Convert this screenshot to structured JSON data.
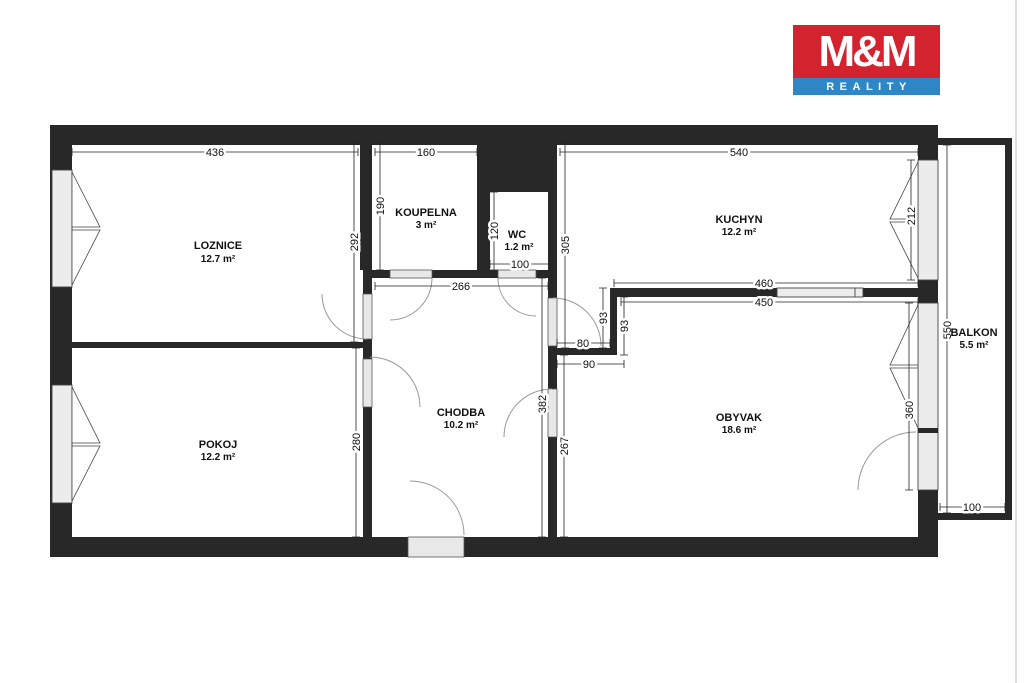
{
  "logo": {
    "line1": "M&M",
    "line2": "REALITY",
    "brand_red": "#d2232e",
    "brand_blue": "#2e86c7"
  },
  "plan": {
    "wall_color": "#282828"
  },
  "rooms": [
    {
      "id": "loznice",
      "name": "LOZNICE",
      "area": "12.7 m²"
    },
    {
      "id": "koupelna",
      "name": "KOUPELNA",
      "area": "3 m²"
    },
    {
      "id": "wc",
      "name": "WC",
      "area": "1.2 m²"
    },
    {
      "id": "kuchyn",
      "name": "KUCHYN",
      "area": "12.2 m²"
    },
    {
      "id": "pokoj",
      "name": "POKOJ",
      "area": "12.2 m²"
    },
    {
      "id": "chodba",
      "name": "CHODBA",
      "area": "10.2 m²"
    },
    {
      "id": "obyvak",
      "name": "OBYVAK",
      "area": "18.6 m²"
    },
    {
      "id": "balkon",
      "name": "BALKON",
      "area": "5.5 m²"
    }
  ],
  "dims": {
    "loznice_width": "436",
    "koupelna_width": "160",
    "kuchyn_width": "540",
    "koupelna_height": "190",
    "loznice_height": "292",
    "wc_height": "120",
    "wc_width": "100",
    "kuchyn_height": "305",
    "kuchyn_window": "212",
    "chodba_width": "266",
    "obyvak_top_outer": "460",
    "obyvak_top_inner": "450",
    "passage_depth_a": "93",
    "passage_depth_b": "93",
    "passage_width": "80",
    "passage_outer": "90",
    "pokoj_height": "280",
    "chodba_height": "382",
    "obyvak_left_height": "267",
    "obyvak_window": "360",
    "balkon_height": "550",
    "balkon_width": "100"
  }
}
